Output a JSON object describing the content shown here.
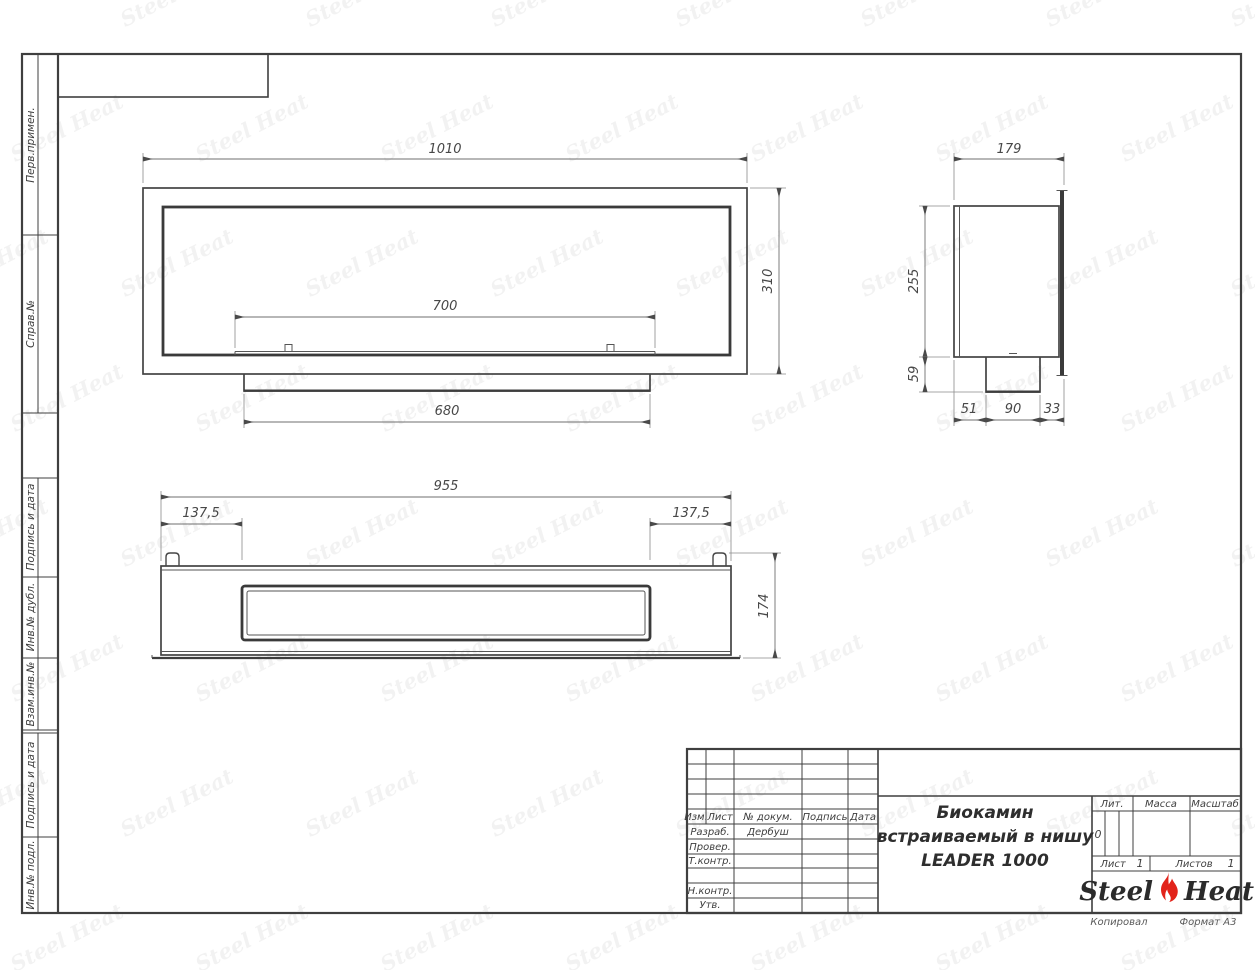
{
  "sheet": {
    "copied_label": "Копировал",
    "format_label": "Формат А3"
  },
  "watermark": {
    "text": "Steel Heat"
  },
  "colors": {
    "flame_red": "#e2231a",
    "line_dark": "#3f3f3f"
  },
  "sidebar": {
    "labels": [
      "Перв.примен.",
      "Справ.№",
      "Подпись и дата",
      "Инв.№ дубл.",
      "Взам.инв.№",
      "Подпись и дата",
      "Инв.№ подл."
    ]
  },
  "views": {
    "front": {
      "dims": {
        "width": "1010",
        "height": "310",
        "slot_width": "700",
        "base_width": "680"
      }
    },
    "side": {
      "dims": {
        "depth": "179",
        "body_height": "255",
        "base_height": "59",
        "back_offset": "51",
        "base_depth": "90",
        "front_offset": "33"
      }
    },
    "bottom": {
      "dims": {
        "width": "955",
        "left_inset": "137,5",
        "right_inset": "137,5",
        "height": "174"
      }
    }
  },
  "title_block": {
    "revision_header": [
      "Изм.",
      "Лист",
      "№ докум.",
      "Подпись",
      "Дата"
    ],
    "signature_rows": [
      {
        "label": "Разраб.",
        "value": "Дербуш"
      },
      {
        "label": "Провер.",
        "value": ""
      },
      {
        "label": "Т.контр.",
        "value": ""
      },
      {
        "label": "Н.контр.",
        "value": ""
      },
      {
        "label": "Утв.",
        "value": ""
      }
    ],
    "title_lines": [
      "Биокамин",
      "встраиваемый в нишу",
      "LEADER 1000"
    ],
    "lit_label": "Лит.",
    "lit_value": "0",
    "mass_label": "Масса",
    "scale_label": "Масштаб",
    "sheet_label": "Лист",
    "sheet_number": "1",
    "sheets_label": "Листов",
    "sheets_total": "1",
    "logo": {
      "word1": "Steel",
      "word2": "Heat"
    }
  }
}
